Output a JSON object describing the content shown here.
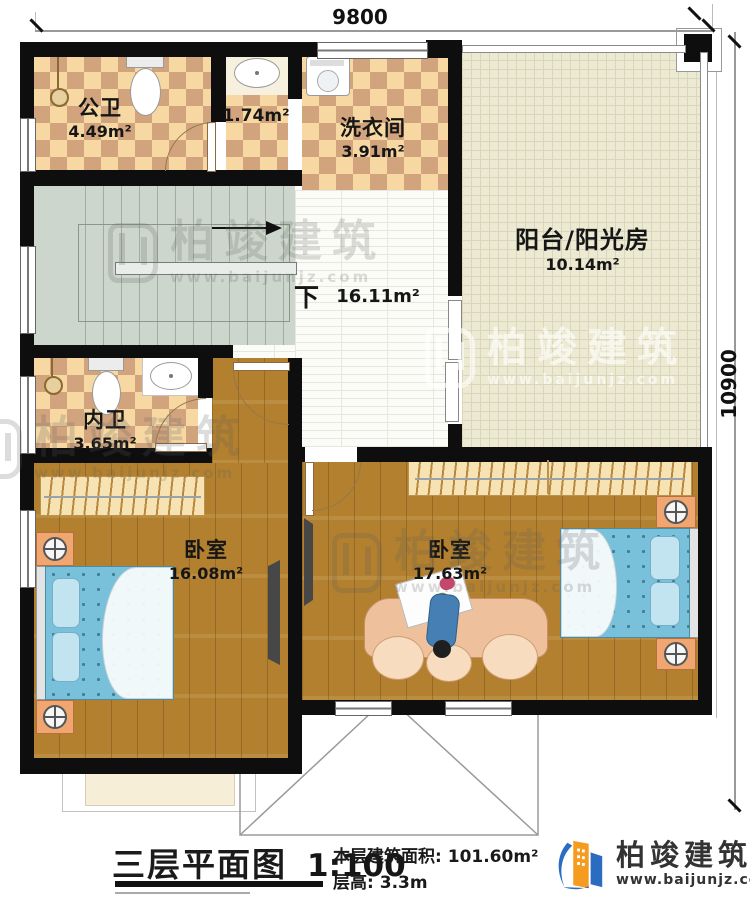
{
  "dimensions": {
    "top": "9800",
    "right": "10900"
  },
  "rooms": {
    "public_bath": {
      "name": "公卫",
      "area": "4.49m²"
    },
    "nook": {
      "area": "1.74m²"
    },
    "laundry": {
      "name": "洗衣间",
      "area": "3.91m²"
    },
    "balcony": {
      "name": "阳台/阳光房",
      "area": "10.14m²"
    },
    "hall": {
      "stair_label": "下",
      "area": "16.11m²"
    },
    "ensuite_bath": {
      "name": "内卫",
      "area": "3.65m²"
    },
    "bedroom_left": {
      "name": "卧室",
      "area": "16.08m²"
    },
    "bedroom_right": {
      "name": "卧室",
      "area": "17.63m²"
    }
  },
  "title_block": {
    "plan_title": "三层平面图",
    "scale": "1:100",
    "area_label": "本层建筑面积:",
    "area_value": "101.60m²",
    "height_label": "层高:",
    "height_value": "3.3m"
  },
  "brand": {
    "name": "柏竣建筑",
    "url": "www.baijunjz.com"
  },
  "colors": {
    "wall": "#0e0e0e",
    "wood": "#b2802f",
    "tile_light": "#f7d8a2",
    "tile_dark": "#d2a47e",
    "balcony": "#edead3",
    "stairs": "#cdd6cc",
    "bed": "#79c0da",
    "logo_blue": "#2a6cc0",
    "logo_orange": "#f59c20"
  }
}
